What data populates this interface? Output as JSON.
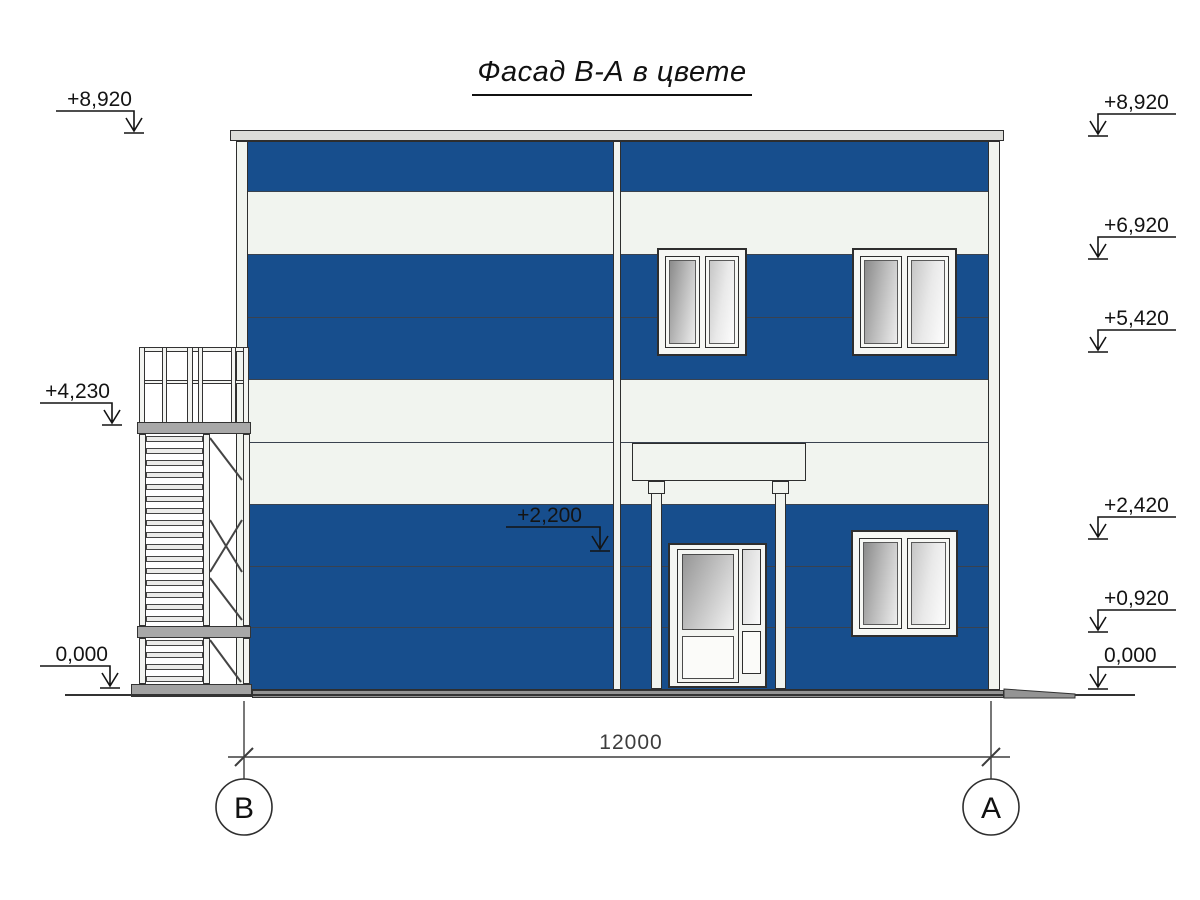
{
  "title": {
    "text": "Фасад В-А в цвете"
  },
  "colors": {
    "panel_blue": "#174e8d",
    "panel_white": "#f1f4ef",
    "cap_gray": "#dcdcd8",
    "pavement_gray": "#949494"
  },
  "facade": {
    "bands": [
      {
        "color": "panel_blue"
      },
      {
        "color": "panel_white"
      },
      {
        "color": "panel_blue"
      },
      {
        "color": "panel_blue"
      },
      {
        "color": "panel_white"
      },
      {
        "color": "panel_white"
      },
      {
        "color": "panel_blue"
      },
      {
        "color": "panel_blue"
      },
      {
        "color": "panel_blue"
      }
    ]
  },
  "elevation_markers": {
    "left": [
      {
        "label": "+8,920"
      },
      {
        "label": "+4,230"
      },
      {
        "label": "0,000"
      }
    ],
    "right": [
      {
        "label": "+8,920"
      },
      {
        "label": "+6,920"
      },
      {
        "label": "+5,420"
      },
      {
        "label": "+2,420"
      },
      {
        "label": "+0,920"
      },
      {
        "label": "0,000"
      }
    ],
    "inner": [
      {
        "label": "+2,200"
      }
    ]
  },
  "dimension": {
    "value": "12000"
  },
  "axes": [
    {
      "label": "В"
    },
    {
      "label": "А"
    }
  ]
}
